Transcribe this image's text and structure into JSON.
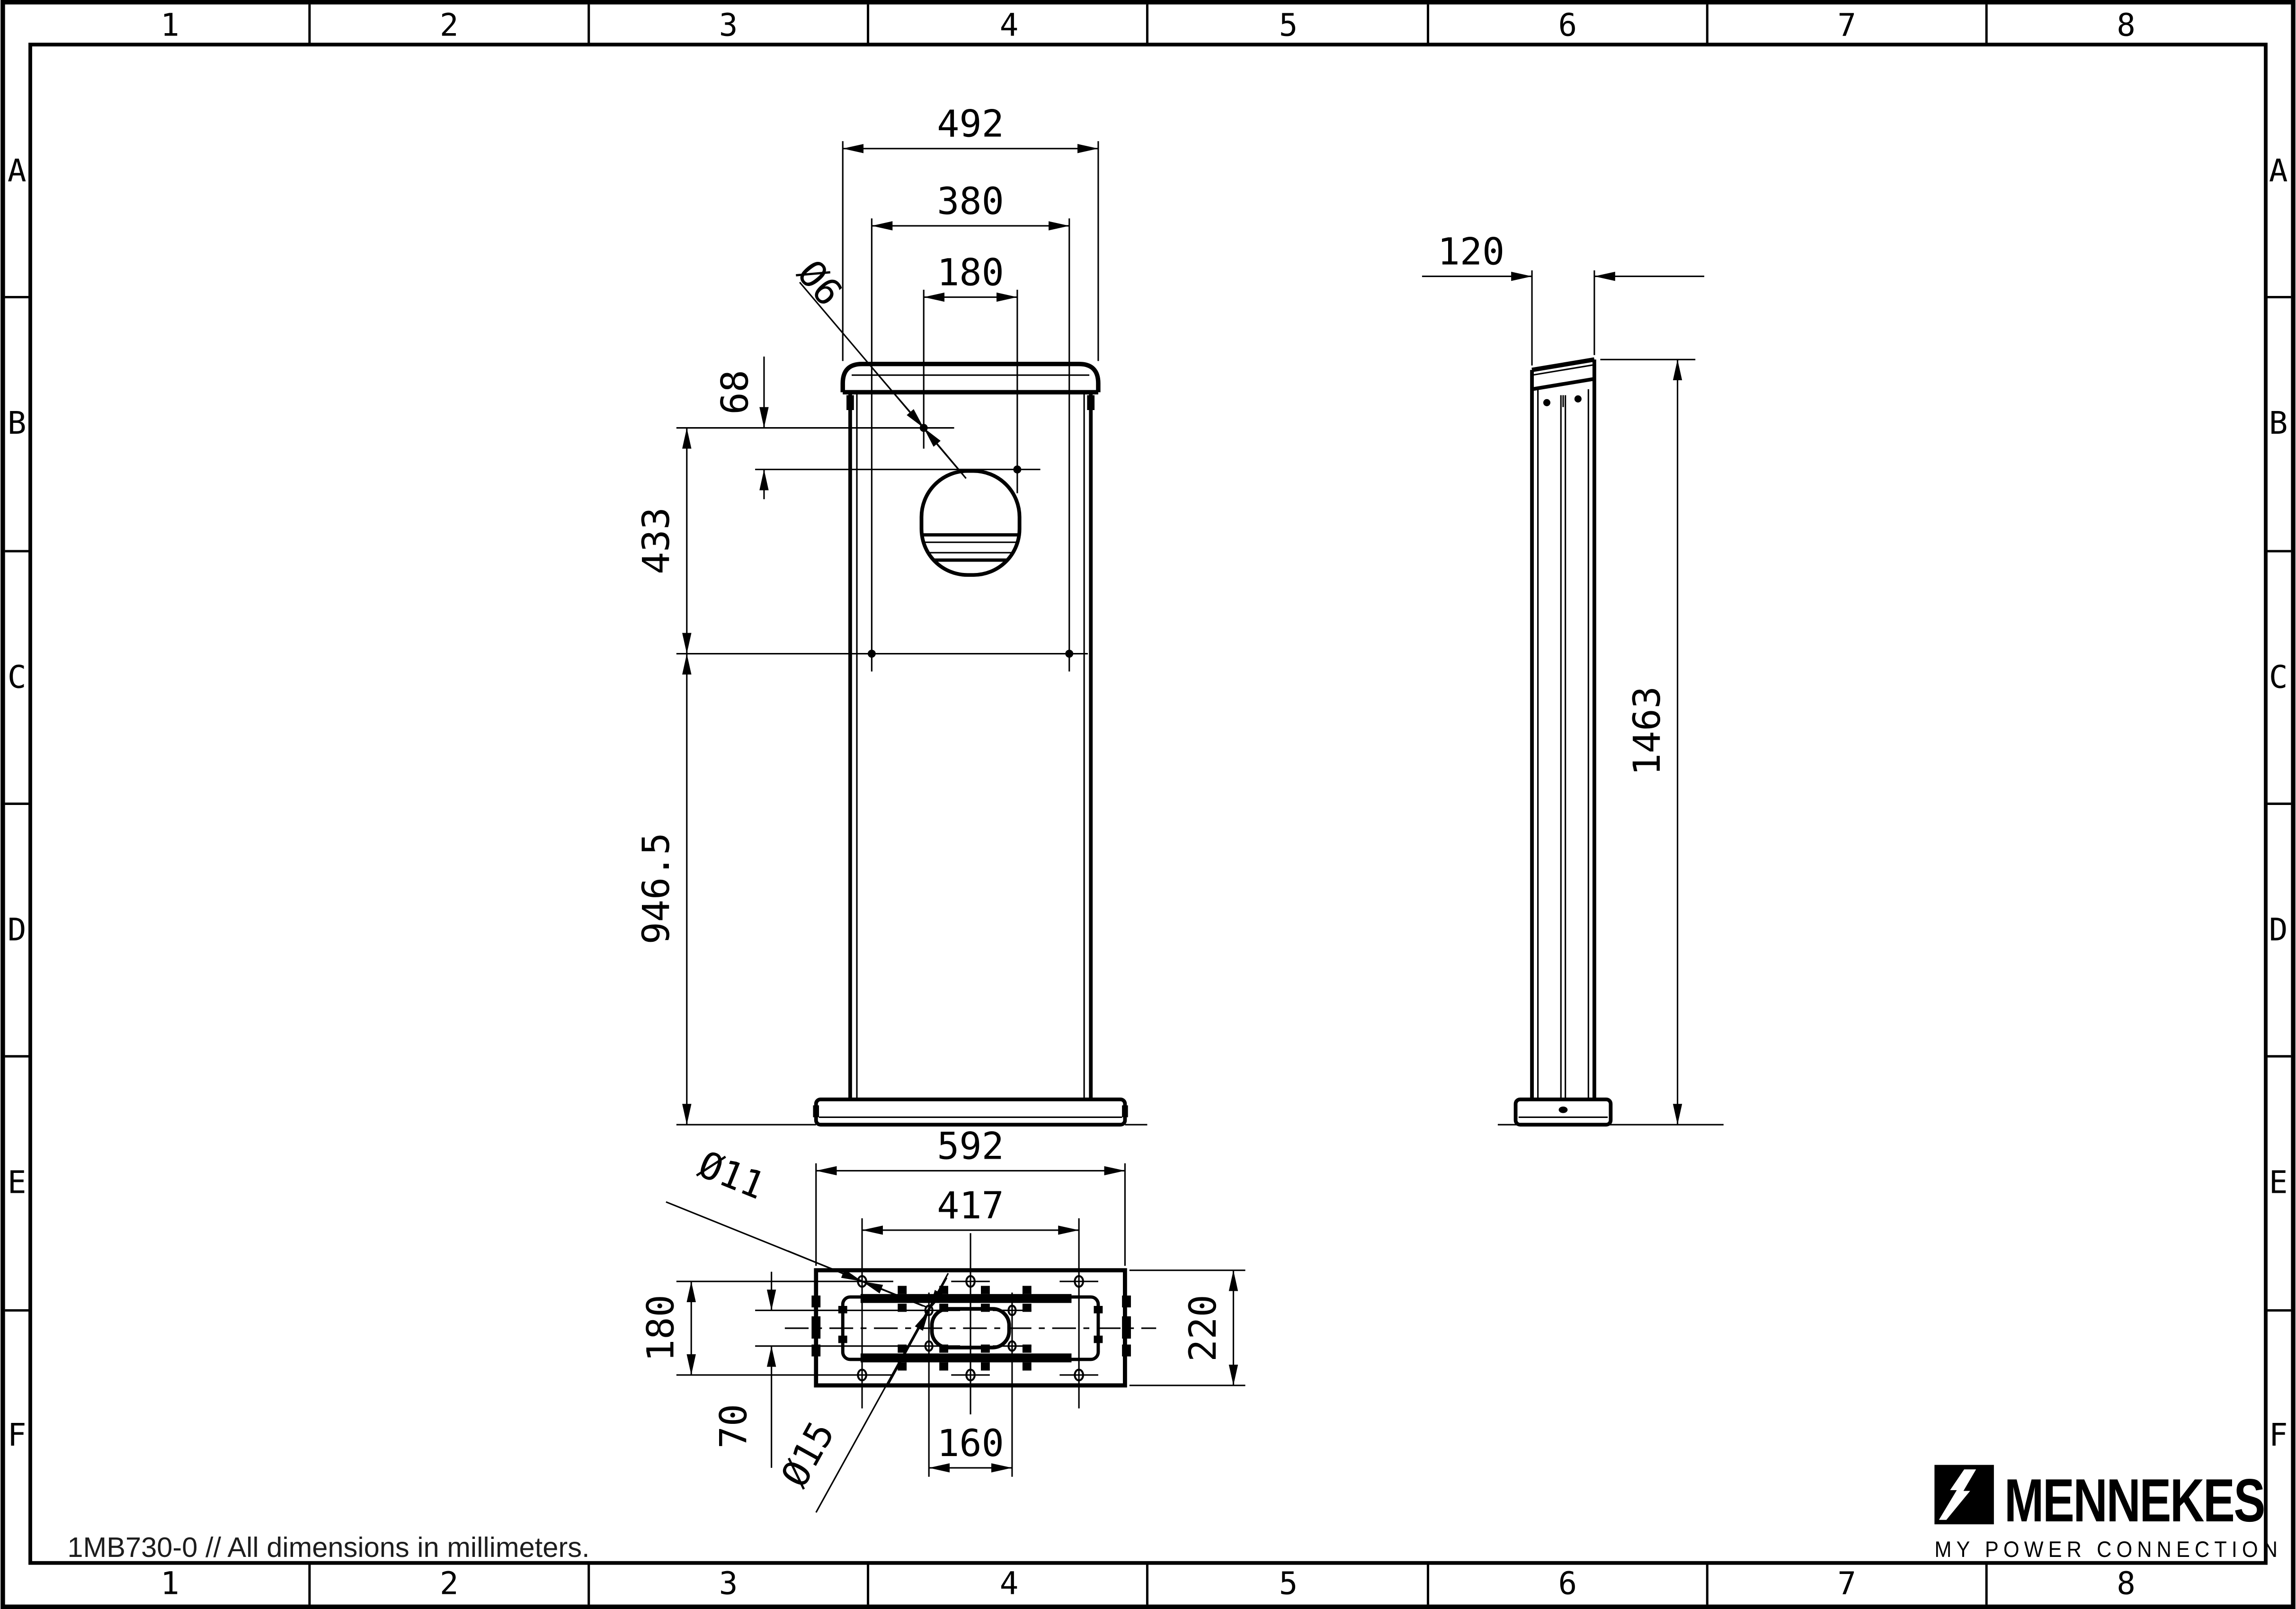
{
  "sheet": {
    "bg_color": "#ffffff",
    "line_color": "#000000",
    "footer_note": "1MB730-0 // All dimensions in millimeters.",
    "grid": {
      "columns": [
        "1",
        "2",
        "3",
        "4",
        "5",
        "6",
        "7",
        "8"
      ],
      "rows": [
        "A",
        "B",
        "C",
        "D",
        "E",
        "F"
      ]
    },
    "logo": {
      "brand": "MENNEKES",
      "tagline": "MY POWER CONNECTION"
    }
  },
  "views": {
    "front": {
      "dims": {
        "cap_width": "492",
        "lower_hole_span": "380",
        "upper_hole_span": "180",
        "upper_hole_dia": "Ø6",
        "cap_to_hole_offset": "68",
        "hole_rows_distance": "433",
        "lower_body_height": "946.5"
      }
    },
    "side": {
      "dims": {
        "depth": "120",
        "total_height": "1463"
      }
    },
    "bottom": {
      "dims": {
        "base_width": "592",
        "anchor_span_x": "417",
        "anchor_dia": "Ø11",
        "anchor_span_y": "180",
        "cable_span_y": "70",
        "cable_dia": "Ø15",
        "cable_span_x": "160",
        "base_depth": "220"
      }
    }
  }
}
